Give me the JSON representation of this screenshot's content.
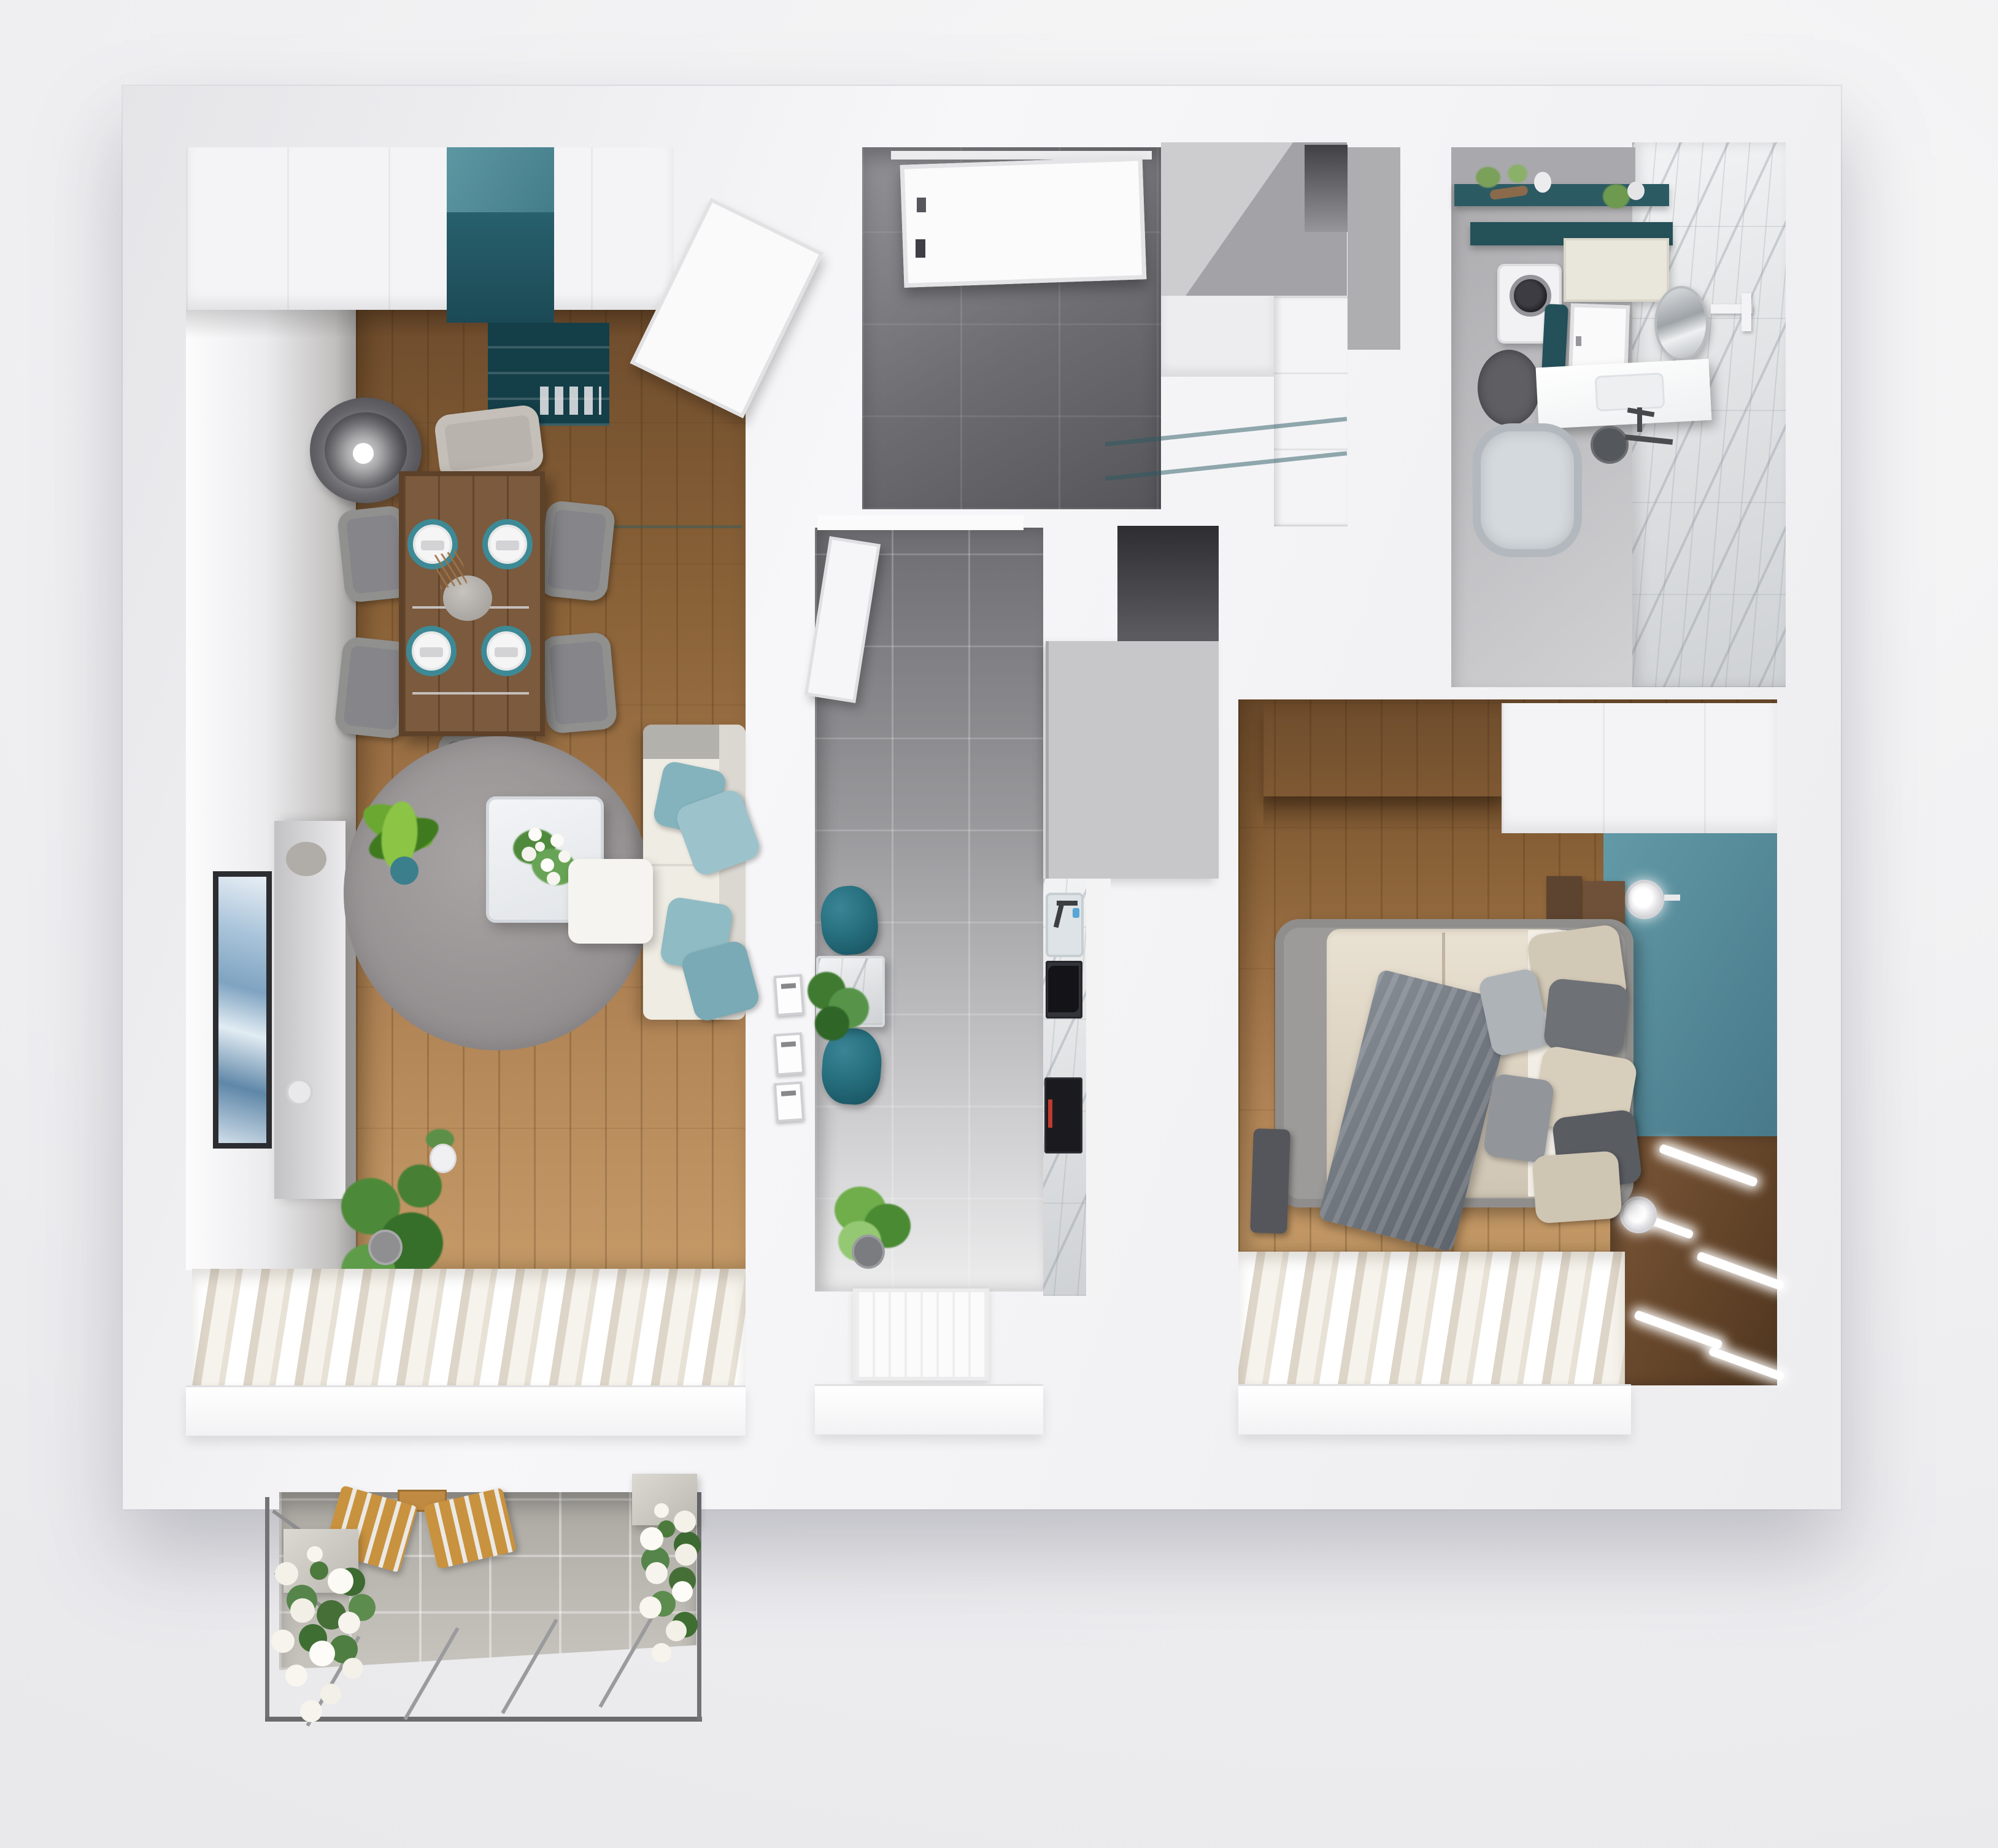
{
  "scene": {
    "type": "3d-floor-plan-render",
    "view": "top-down axonometric",
    "description": "Photorealistic 3D rendered floor plan of a one-bedroom apartment with balcony",
    "background_color": "#f1f1f3"
  },
  "palette": {
    "wall_white": "#f7f7f9",
    "wall_shadow": "#c9c9cd",
    "wood_floor": "#a87b4e",
    "wood_floor_light": "#c59a67",
    "hall_tile_dark": "#5e5e62",
    "kitchen_tile_light": "#ededee",
    "teal_cabinet": "#4e8793",
    "teal_dark": "#1f505b",
    "teal_accent_wall": "#578e9c",
    "teal_chair": "#27707f",
    "teal_pillow": "#8fbcc4",
    "sofa_cream": "#efece4",
    "rug_gray": "#9b9899",
    "dining_wood": "#7b5a3d",
    "marble_white": "#eef0f1",
    "dark_wardrobe": "#4a3424",
    "dresser_wood": "#6f4e31",
    "balcony_tile": "#b9b6b0",
    "railing_gray": "#737376",
    "flower_white": "#f6f4ec",
    "leaf_green": "#4c8a39"
  },
  "rooms": [
    {
      "id": "living-dining",
      "label": "Living / Dining Room",
      "floor": "wood",
      "furniture": [
        "white wardrobe row",
        "teal cabinet unit",
        "dark teal bookshelf",
        "open white door",
        "floor lamp",
        "dining table",
        "six gray chairs",
        "four place settings",
        "vase centerpiece",
        "tv console",
        "wall art seascape",
        "round gray rug",
        "white coffee table",
        "flower bouquet",
        "cream corner sofa",
        "four teal pillows",
        "white ottoman",
        "yucca plant",
        "monstera plant",
        "small potted plant",
        "sheer curtains",
        "window sill"
      ]
    },
    {
      "id": "hallway",
      "label": "Entrance Hall",
      "floor": "dark tile",
      "furniture": [
        "entrance door",
        "built-in closet",
        "sliding white doors",
        "mirror niche",
        "glass partition"
      ]
    },
    {
      "id": "kitchen",
      "label": "Kitchen",
      "floor": "gray tile",
      "furniture": [
        "open door",
        "two teal chairs",
        "marble bistro table",
        "monstera on table",
        "three wall frames",
        "tall cabinet block",
        "marble counter",
        "sink with faucet",
        "black cooktop",
        "black oven",
        "floor plant",
        "white runner rug",
        "window sill"
      ]
    },
    {
      "id": "bathroom",
      "label": "Bathroom",
      "floor": "gray tile",
      "furniture": [
        "teal shelves with plants",
        "washing machine",
        "cream cabinet",
        "teal towel",
        "white door",
        "round mirror",
        "towel bar",
        "white sink counter",
        "faucet",
        "round dark rug",
        "bathtub",
        "shower head",
        "marble wall"
      ]
    },
    {
      "id": "bedroom",
      "label": "Bedroom",
      "floor": "wood",
      "furniture": [
        "dark wood wardrobe",
        "white cabinet run",
        "teal accent wall",
        "two wall sconces",
        "double bed",
        "beige duvet",
        "gray throw blanket",
        "pillow stack",
        "nightstands",
        "dark bench",
        "wood dresser with LED strips",
        "sheer curtains",
        "window sill"
      ]
    },
    {
      "id": "balcony",
      "label": "Balcony",
      "floor": "concrete tile",
      "furniture": [
        "metal railing",
        "two wooden slat chairs",
        "folding table",
        "left flower planter",
        "right flower planter",
        "white petunias"
      ]
    }
  ]
}
